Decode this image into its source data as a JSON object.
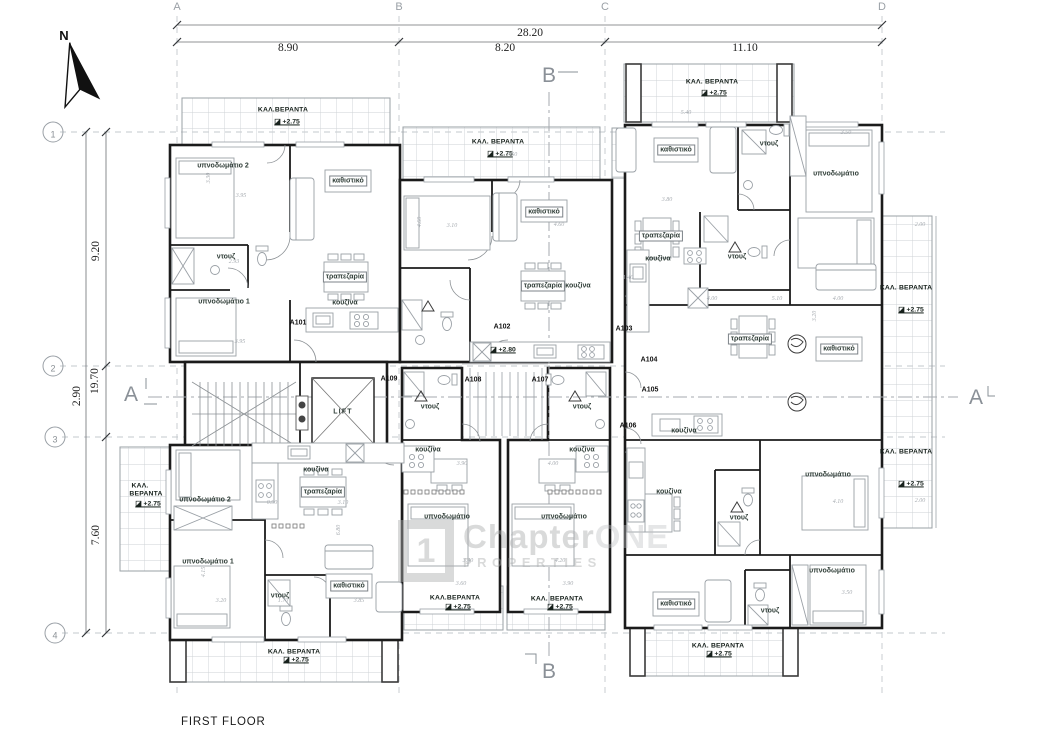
{
  "title": "FIRST FLOOR",
  "north": {
    "label": "N"
  },
  "watermark": {
    "logo_char": "1",
    "name_main": "Chapter",
    "name_accent": "ONE",
    "tagline": "PROPERTIES"
  },
  "colors": {
    "wall": "#1b1b1b",
    "furniture": "#9aa0a6",
    "grid": "#c3c8cd",
    "label": "#2f3d37",
    "watermark": "#aaacae"
  },
  "grid": {
    "columns": [
      {
        "label": "A",
        "x": 177
      },
      {
        "label": "B",
        "x": 399
      },
      {
        "label": "C",
        "x": 605
      },
      {
        "label": "D",
        "x": 882
      }
    ],
    "rows": [
      {
        "label": "1",
        "y": 132
      },
      {
        "label": "2",
        "y": 366
      },
      {
        "label": "3",
        "y": 437
      },
      {
        "label": "4",
        "y": 633
      }
    ]
  },
  "dimensions": {
    "top_total": {
      "t": "28.20",
      "x": 530,
      "y": 33
    },
    "top_segments": [
      {
        "t": "8.90",
        "x": 288,
        "y": 48
      },
      {
        "t": "8.20",
        "x": 505,
        "y": 48
      },
      {
        "t": "11.10",
        "x": 745,
        "y": 48
      }
    ],
    "left_total": {
      "t": "19.70",
      "x": 95,
      "y": 381,
      "r": 1
    },
    "left_segments": [
      {
        "t": "9.20",
        "x": 96,
        "y": 251,
        "r": 1
      },
      {
        "t": "2.90",
        "x": 77,
        "y": 396,
        "r": 1
      },
      {
        "t": "7.60",
        "x": 96,
        "y": 535,
        "r": 1
      }
    ]
  },
  "section_markers": [
    {
      "t": "B",
      "x": 549,
      "y": 76
    },
    {
      "t": "B",
      "x": 549,
      "y": 672
    },
    {
      "t": "A",
      "x": 131,
      "y": 395
    },
    {
      "t": "A",
      "x": 976,
      "y": 398
    }
  ],
  "apartment_labels": [
    {
      "t": "A101",
      "x": 298,
      "y": 323
    },
    {
      "t": "A102",
      "x": 502,
      "y": 327
    },
    {
      "t": "A103",
      "x": 624,
      "y": 329
    },
    {
      "t": "A104",
      "x": 649,
      "y": 360
    },
    {
      "t": "A105",
      "x": 650,
      "y": 390
    },
    {
      "t": "A106",
      "x": 628,
      "y": 426
    },
    {
      "t": "A107",
      "x": 540,
      "y": 380
    },
    {
      "t": "A108",
      "x": 473,
      "y": 380
    },
    {
      "t": "A109",
      "x": 389,
      "y": 379
    }
  ],
  "room_labels": [
    {
      "t": "υπνοδωμάτιο 2",
      "x": 223,
      "y": 166
    },
    {
      "t": "καθιστικό",
      "x": 348,
      "y": 181,
      "box": 1
    },
    {
      "t": "ντουζ",
      "x": 226,
      "y": 257
    },
    {
      "t": "υπνοδωμάτιο 1",
      "x": 224,
      "y": 302
    },
    {
      "t": "τραπεζαρία",
      "x": 345,
      "y": 277,
      "box": 1
    },
    {
      "t": "κουζίνα",
      "x": 345,
      "y": 303
    },
    {
      "t": "καθιστικό",
      "x": 544,
      "y": 212,
      "box": 1
    },
    {
      "t": "τραπεζαρία",
      "x": 543,
      "y": 286,
      "box": 1
    },
    {
      "t": "κουζίνα",
      "x": 578,
      "y": 286
    },
    {
      "t": "καθιστικό",
      "x": 676,
      "y": 150,
      "box": 1
    },
    {
      "t": "ντουζ",
      "x": 769,
      "y": 144
    },
    {
      "t": "υπνοδωμάτιο",
      "x": 836,
      "y": 174
    },
    {
      "t": "τραπεζαρία",
      "x": 661,
      "y": 236,
      "box": 1
    },
    {
      "t": "κουζίνα",
      "x": 658,
      "y": 259
    },
    {
      "t": "ντουζ",
      "x": 737,
      "y": 257
    },
    {
      "t": "τραπεζαρία",
      "x": 750,
      "y": 339,
      "box": 1
    },
    {
      "t": "καθιστικό",
      "x": 839,
      "y": 349,
      "box": 1
    },
    {
      "t": "κουζίνα",
      "x": 684,
      "y": 431
    },
    {
      "t": "κουζίνα",
      "x": 669,
      "y": 492
    },
    {
      "t": "ντουζ",
      "x": 739,
      "y": 518
    },
    {
      "t": "υπνοδωμάτιο",
      "x": 828,
      "y": 475
    },
    {
      "t": "καθιστικό",
      "x": 676,
      "y": 604,
      "box": 1
    },
    {
      "t": "ντουζ",
      "x": 770,
      "y": 611
    },
    {
      "t": "υπνοδωμάτιο",
      "x": 832,
      "y": 571
    },
    {
      "t": "ντουζ",
      "x": 430,
      "y": 407
    },
    {
      "t": "κουζίνα",
      "x": 428,
      "y": 450
    },
    {
      "t": "υπνοδωμάτιο",
      "x": 447,
      "y": 517
    },
    {
      "t": "ντουζ",
      "x": 582,
      "y": 407
    },
    {
      "t": "κουζίνα",
      "x": 582,
      "y": 450
    },
    {
      "t": "υπνοδωμάτιο",
      "x": 564,
      "y": 517
    },
    {
      "t": "κουζίνα",
      "x": 316,
      "y": 470
    },
    {
      "t": "τραπεζαρία",
      "x": 323,
      "y": 492,
      "box": 1
    },
    {
      "t": "υπνοδωμάτιο 2",
      "x": 205,
      "y": 500
    },
    {
      "t": "υπνοδωμάτιο 1",
      "x": 208,
      "y": 562
    },
    {
      "t": "ντουζ",
      "x": 280,
      "y": 596
    },
    {
      "t": "καθιστικό",
      "x": 349,
      "y": 586,
      "box": 1
    }
  ],
  "lift_label": {
    "t": "LIFT",
    "x": 343,
    "y": 412
  },
  "veranda_labels": [
    {
      "t": "ΚΑΛ.ΒΕΡΑΝΤΑ",
      "x": 283,
      "y": 110
    },
    {
      "t": "ΚΑΛ. ΒΕΡΑΝΤΑ",
      "x": 498,
      "y": 142
    },
    {
      "t": "ΚΑΛ. ΒΕΡΑΝΤΑ",
      "x": 712,
      "y": 82
    },
    {
      "t": "ΚΑΛ. ΒΕΡΑΝΤΑ",
      "x": 906,
      "y": 288
    },
    {
      "t": "ΚΑΛ. ΒΕΡΑΝΤΑ",
      "x": 906,
      "y": 452
    },
    {
      "t": "ΚΑΛ.",
      "x": 140,
      "y": 486
    },
    {
      "t": "ΒΕΡΑΝΤΑ",
      "x": 146,
      "y": 494
    },
    {
      "t": "ΚΑΛ.ΒΕΡΑΝΤΑ",
      "x": 455,
      "y": 598
    },
    {
      "t": "ΚΑΛ. ΒΕΡΑΝΤΑ",
      "x": 557,
      "y": 599
    },
    {
      "t": "ΚΑΛ. ΒΕΡΑΝΤΑ",
      "x": 294,
      "y": 652
    },
    {
      "t": "ΚΑΛ. ΒΕΡΑΝΤΑ",
      "x": 718,
      "y": 646
    }
  ],
  "level_markers": [
    {
      "t": "+2.75",
      "x": 287,
      "y": 122
    },
    {
      "t": "+2.75",
      "x": 500,
      "y": 154
    },
    {
      "t": "+2.75",
      "x": 714,
      "y": 93
    },
    {
      "t": "+2.75",
      "x": 911,
      "y": 310
    },
    {
      "t": "+2.75",
      "x": 911,
      "y": 484
    },
    {
      "t": "+2.75",
      "x": 148,
      "y": 504
    },
    {
      "t": "+2.75",
      "x": 458,
      "y": 607
    },
    {
      "t": "+2.75",
      "x": 560,
      "y": 607
    },
    {
      "t": "+2.75",
      "x": 296,
      "y": 660
    },
    {
      "t": "+2.75",
      "x": 719,
      "y": 654
    },
    {
      "t": "+2.80",
      "x": 503,
      "y": 350
    }
  ],
  "minor_dims": [
    {
      "t": "3.95",
      "x": 241,
      "y": 196
    },
    {
      "t": "3.30",
      "x": 209,
      "y": 178,
      "r": 1
    },
    {
      "t": "3.95",
      "x": 240,
      "y": 342
    },
    {
      "t": "2.93",
      "x": 234,
      "y": 262
    },
    {
      "t": "3.10",
      "x": 452,
      "y": 226
    },
    {
      "t": "4.60",
      "x": 420,
      "y": 222,
      "r": 1
    },
    {
      "t": "4.60",
      "x": 559,
      "y": 225
    },
    {
      "t": "7.50",
      "x": 512,
      "y": 155
    },
    {
      "t": "3.80",
      "x": 667,
      "y": 200
    },
    {
      "t": "5.40",
      "x": 686,
      "y": 113
    },
    {
      "t": "3.50",
      "x": 846,
      "y": 133
    },
    {
      "t": "4.00",
      "x": 712,
      "y": 299
    },
    {
      "t": "5.10",
      "x": 777,
      "y": 299
    },
    {
      "t": "4.00",
      "x": 838,
      "y": 299
    },
    {
      "t": "3.20",
      "x": 815,
      "y": 316,
      "r": 1
    },
    {
      "t": "1.40",
      "x": 628,
      "y": 278
    },
    {
      "t": "3.90",
      "x": 462,
      "y": 464
    },
    {
      "t": "4.00",
      "x": 553,
      "y": 464
    },
    {
      "t": "3.40",
      "x": 468,
      "y": 561
    },
    {
      "t": "4.20",
      "x": 560,
      "y": 561
    },
    {
      "t": "0.90",
      "x": 272,
      "y": 503
    },
    {
      "t": "3.10",
      "x": 343,
      "y": 503
    },
    {
      "t": "6.80",
      "x": 339,
      "y": 530,
      "r": 1
    },
    {
      "t": "4.15",
      "x": 204,
      "y": 572,
      "r": 1
    },
    {
      "t": "3.20",
      "x": 221,
      "y": 601
    },
    {
      "t": "1.70",
      "x": 283,
      "y": 601
    },
    {
      "t": "3.85",
      "x": 359,
      "y": 601
    },
    {
      "t": "4.10",
      "x": 838,
      "y": 502
    },
    {
      "t": "3.50",
      "x": 847,
      "y": 593
    },
    {
      "t": "2.00",
      "x": 920,
      "y": 225
    },
    {
      "t": "2.00",
      "x": 920,
      "y": 501
    },
    {
      "t": "3.60",
      "x": 461,
      "y": 584
    },
    {
      "t": "3.90",
      "x": 568,
      "y": 584
    }
  ]
}
